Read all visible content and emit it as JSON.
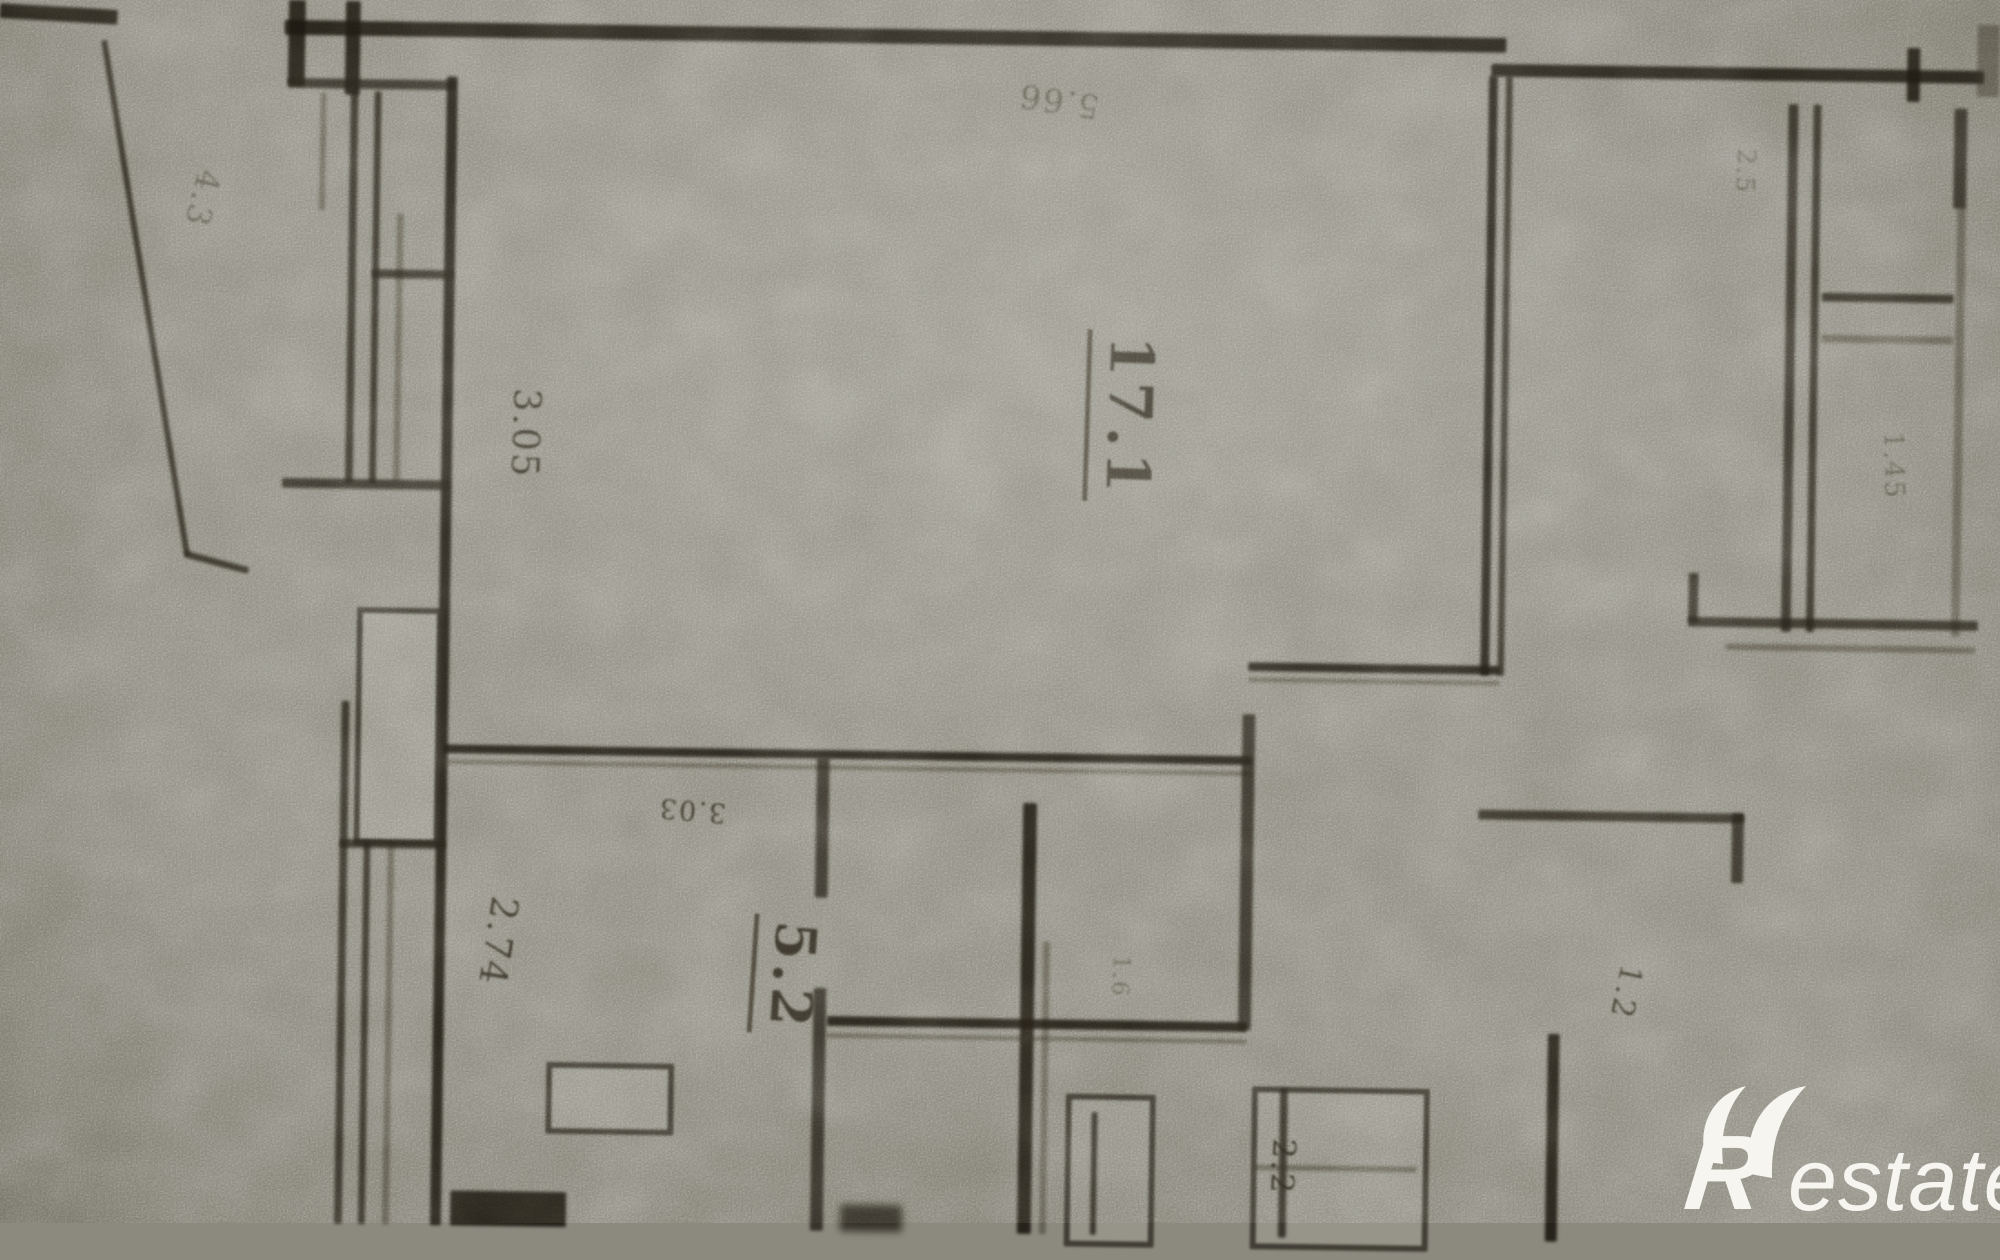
{
  "meta": {
    "document_type": "scanned apartment floor plan (blurry photo of a technical drawing)",
    "orientation_note": "plan and annotations are rotated ~90 degrees on the page"
  },
  "palette": {
    "paper": "#8c8a7e",
    "ink": "#211d14",
    "ink_soft": "#4a453a",
    "watermark": "#f6f5ef"
  },
  "plan": {
    "labels": [
      {
        "id": "room-area-17-1",
        "text": "17.1",
        "x": 1128,
        "y": 404,
        "rot": 91,
        "size": 60,
        "cls": "room"
      },
      {
        "id": "room-area-5-2",
        "text": "5.2",
        "x": 800,
        "y": 968,
        "rot": 93,
        "size": 56,
        "cls": "room"
      },
      {
        "id": "dim-3-05",
        "text": "3.05",
        "x": 532,
        "y": 430,
        "rot": 91,
        "size": 37,
        "cls": "dim"
      },
      {
        "id": "dim-2-74",
        "text": "2.74",
        "x": 512,
        "y": 938,
        "rot": 98,
        "size": 37,
        "cls": "dim"
      },
      {
        "id": "dim-5-66",
        "text": "5.66",
        "x": 1060,
        "y": 90,
        "rot": 188,
        "size": 33,
        "cls": "faint"
      },
      {
        "id": "dim-4-3",
        "text": "4.3",
        "x": 206,
        "y": 200,
        "rot": 103,
        "size": 33,
        "cls": "faint"
      },
      {
        "id": "dim-3-03",
        "text": "3.03",
        "x": 704,
        "y": 804,
        "rot": 184,
        "size": 27,
        "cls": "dim"
      },
      {
        "id": "dim-2-5",
        "text": "2.5",
        "x": 1748,
        "y": 150,
        "rot": 92,
        "size": 25,
        "cls": "faint"
      },
      {
        "id": "dim-1-45",
        "text": "1.45",
        "x": 1900,
        "y": 442,
        "rot": 88,
        "size": 27,
        "cls": "faint"
      },
      {
        "id": "dim-1-2",
        "text": "1.2",
        "x": 1640,
        "y": 972,
        "rot": 101,
        "size": 31,
        "cls": "dim"
      },
      {
        "id": "dim-2-2",
        "text": "2.2",
        "x": 1300,
        "y": 1152,
        "rot": 92,
        "size": 32,
        "cls": "dim"
      },
      {
        "id": "dim-1-6",
        "text": "1.6",
        "x": 1134,
        "y": 964,
        "rot": 92,
        "size": 23,
        "cls": "faint"
      }
    ]
  },
  "watermark": {
    "logo_r": "R",
    "logo_rest": "estate"
  }
}
